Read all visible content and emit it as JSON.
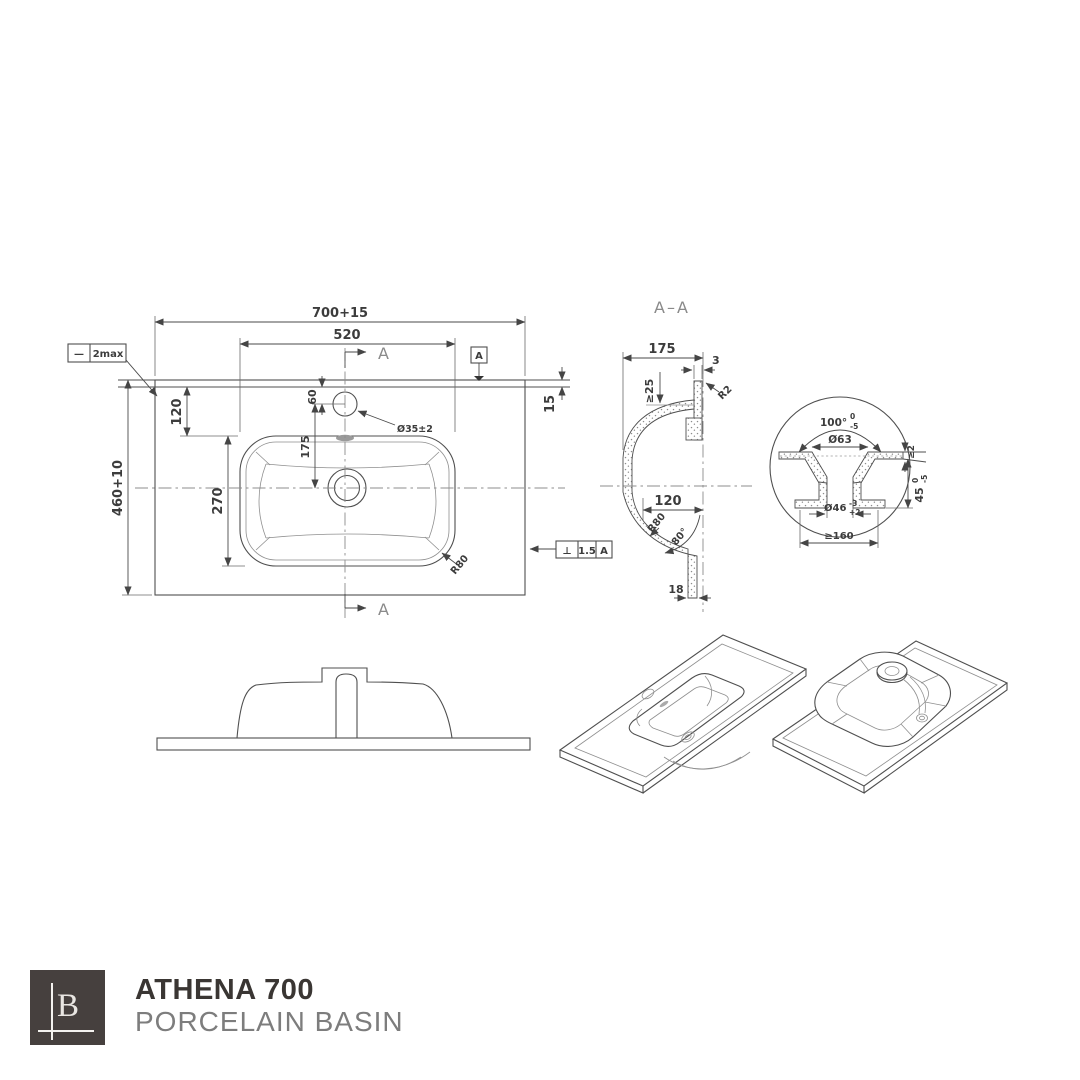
{
  "colors": {
    "line": "#4f4f4f",
    "logo_bg": "#46403e",
    "title": "#3a3633",
    "subtitle": "#7d7d7d"
  },
  "footer": {
    "logo_letter": "B",
    "title": "ATHENA 700",
    "subtitle": "PORCELAIN BASIN"
  },
  "plan": {
    "dim_overall_width": "700+15",
    "dim_inner_width": "520",
    "dim_overall_depth": "460+10",
    "dim_back_offset": "120",
    "dim_bowl_width": "270",
    "dim_hole_offset": "60",
    "dim_hole_to_centre": "175",
    "dim_back_edge": "15",
    "flatness_symbol": "—",
    "flatness_value": "2max",
    "datum_label": "A",
    "section_arrow_top": "A",
    "section_arrow_bottom": "A",
    "tap_hole_dia": "Ø35±2",
    "corner_radius": "R80",
    "perpendicularity_symbol": "⊥",
    "perpendicularity_value": "1.5",
    "perpendicularity_datum": "A"
  },
  "section": {
    "title": "A–A",
    "dim_depth": "175",
    "dim_rim_thickness": "3",
    "dim_min_overhang": "≥25",
    "radius_rim": "R2",
    "dim_bowl_bottom": "120",
    "radius_bowl": "R80",
    "angle_outlet_wall": "80°",
    "dim_outlet_width": "18"
  },
  "detail": {
    "angle_recess": "100°",
    "angle_tol_upper": "0",
    "angle_tol_lower": "-5",
    "dia_recess_top": "Ø63",
    "dia_outlet": "Ø46",
    "dia_outlet_tol_upper": "-3",
    "dia_outlet_tol_lower": "+2",
    "dim_min_edge": "≥2",
    "dim_recess_depth": "45",
    "depth_tol_upper": "0",
    "depth_tol_lower": "-5",
    "dim_min_flat": "≥160"
  }
}
